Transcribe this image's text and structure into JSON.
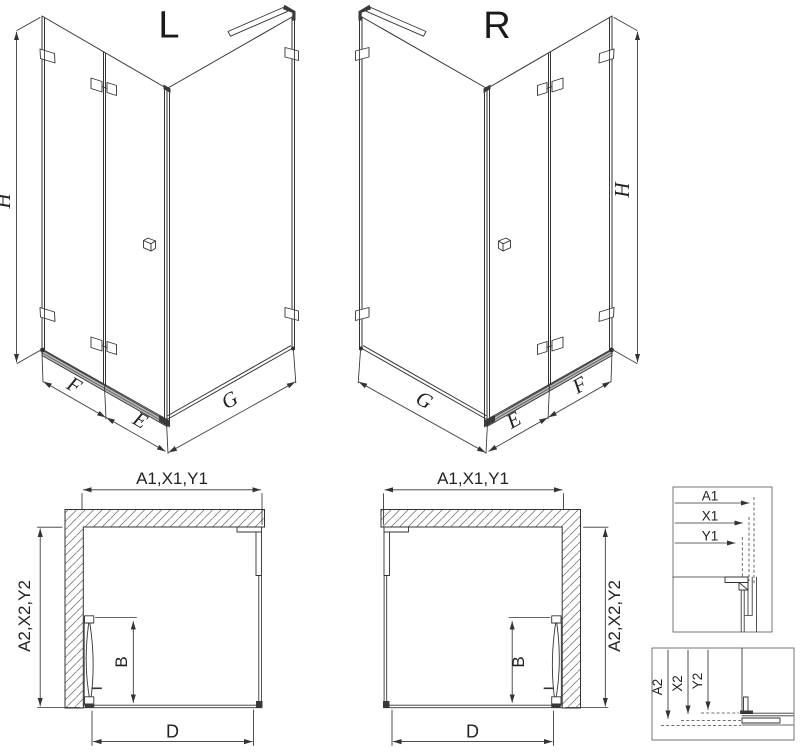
{
  "views": {
    "iso_left": {
      "title": "L",
      "dim_height": "H",
      "dim_fixed": "F",
      "dim_door": "E",
      "dim_side": "G"
    },
    "iso_right": {
      "title": "R",
      "dim_height": "H",
      "dim_fixed": "F",
      "dim_door": "E",
      "dim_side": "G"
    },
    "plan_left": {
      "dim_top": "A1,X1,Y1",
      "dim_side": "A2,X2,Y2",
      "dim_door": "B",
      "dim_bottom": "D"
    },
    "plan_right": {
      "dim_top": "A1,X1,Y1",
      "dim_side": "A2,X2,Y2",
      "dim_door": "B",
      "dim_bottom": "D"
    },
    "detail_width": {
      "dim_a": "A1",
      "dim_x": "X1",
      "dim_y": "Y1"
    },
    "detail_depth": {
      "dim_a": "A2",
      "dim_x": "X2",
      "dim_y": "Y2"
    }
  },
  "colors": {
    "line": "#333333",
    "hatch": "#666666",
    "threshold": "#b9b9b9",
    "background": "#ffffff"
  }
}
